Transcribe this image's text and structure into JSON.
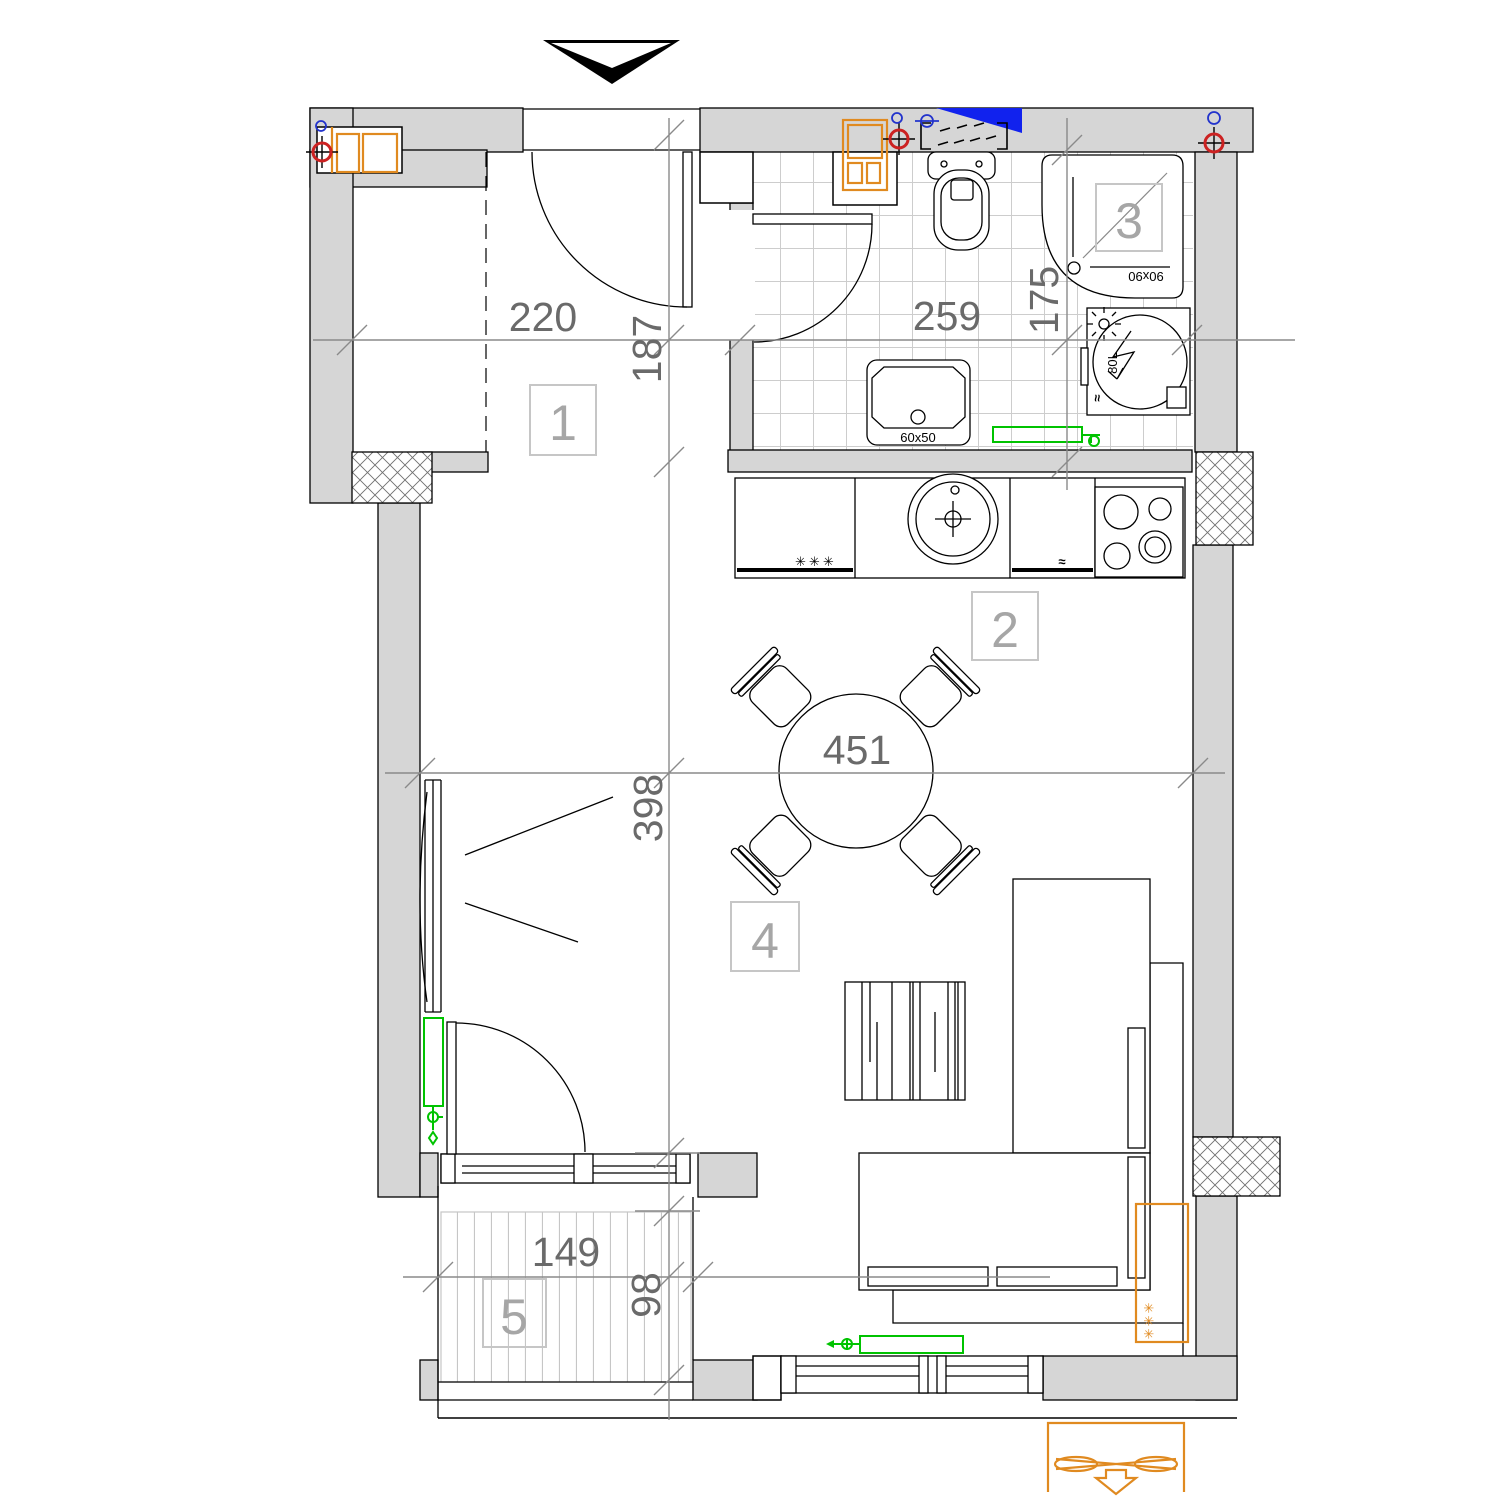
{
  "colors": {
    "wall_fill": "#d6d6d6",
    "line": "#000000",
    "dimension_line": "#8a8a8a",
    "dimension_text": "#6a6a6a",
    "room_label": "#a6a6a6",
    "tile_line": "#cdcdcd",
    "radiator_green": "#00c300",
    "cabinet_orange": "#e08a20",
    "vent_blue": "#1122ee",
    "riser_red": "#cc2222"
  },
  "room_labels": {
    "hall": "1",
    "kitchen": "2",
    "bathroom": "3",
    "living": "4",
    "balcony": "5"
  },
  "dimensions": {
    "hall_width": "220",
    "hall_depth": "187",
    "bath_width": "259",
    "bath_depth": "175",
    "living_width": "451",
    "living_depth": "398",
    "balcony_width": "149",
    "balcony_depth": "98"
  },
  "fixtures": {
    "washbasin_size": "60x50",
    "shower_size": "90x90",
    "water_heater_capacity": "80L",
    "water_heater_mark": "≈",
    "freezer_mark": "✳✳✳",
    "dishwasher_mark": "≈",
    "ac_mark": "✳✳✳"
  }
}
